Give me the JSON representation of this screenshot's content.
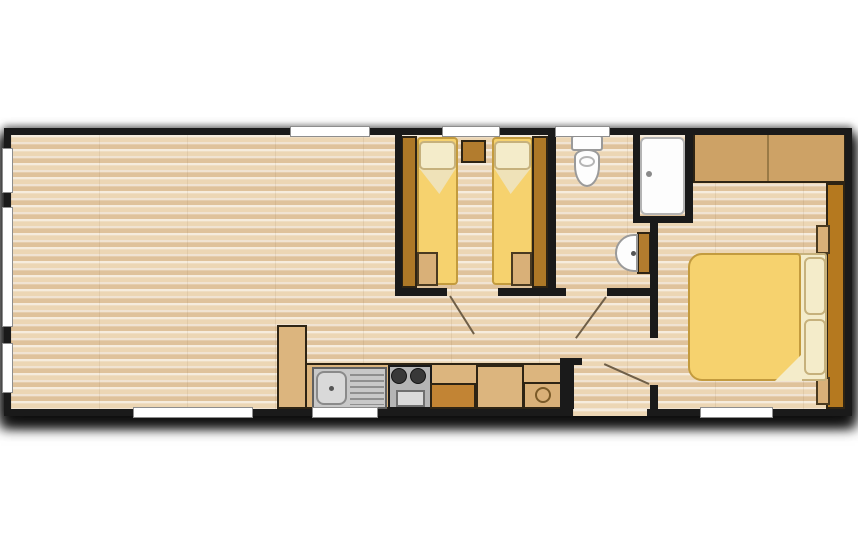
{
  "scene": {
    "title": "mobile-home-floor-plan",
    "description": "Top-down 2-bedroom static caravan floor plan: open lounge left, kitchen run along bottom, twin bedroom and shower room centre, double bedroom right",
    "colors": {
      "wall": "#1a1a1a",
      "floor_base": "#e8d0ad",
      "floor_stripe_light": "#ecd6b4",
      "floor_stripe_dark": "#dfc29b",
      "window_fill": "#ffffff",
      "window_border": "#8e8e8e",
      "wood_dark": "#ad7827",
      "wood_mid": "#cda266",
      "wood_light": "#d9b078",
      "counter_tan": "#dcb57e",
      "cabinet_orange": "#c28434",
      "bed_yellow": "#f6d26e",
      "bed_outline": "#c39b3e",
      "cream": "#f4ecca",
      "cream_outline": "#c6b17c",
      "fixture_white": "#fdfdfd",
      "fixture_border": "#9a9a9a",
      "appliance_gray": "#c8c8c8",
      "door_line": "#6f5f48"
    },
    "plan": {
      "x": 4,
      "y": 128,
      "w": 848,
      "h": 288
    }
  },
  "elements": [
    {
      "name": "floor-base",
      "kind": "rect",
      "cls": "floor",
      "x": 7,
      "y": 7,
      "w": 834,
      "h": 274
    },
    {
      "name": "twin-bedroom-wardrobe-left",
      "kind": "rect",
      "x": 397,
      "y": 8,
      "w": 16,
      "h": 152,
      "fill": "#ad7827",
      "stroke": "#2e2414",
      "sw": 2
    },
    {
      "name": "twin-bed-1-mattress",
      "kind": "rect",
      "x": 413,
      "y": 9,
      "w": 41,
      "h": 148,
      "fill": "#f6d26e",
      "stroke": "#c39b3e",
      "sw": 2,
      "r": "4px"
    },
    {
      "name": "twin-bed-1-sheet-fold",
      "kind": "tri",
      "x": 415,
      "y": 40,
      "w": 37,
      "h": 26,
      "fill": "#efe2b8",
      "clip": "polygon(0 0,100% 0,55% 100%)"
    },
    {
      "name": "twin-bed-1-pillow",
      "kind": "rect",
      "x": 415,
      "y": 13,
      "w": 37,
      "h": 29,
      "fill": "#f4ecca",
      "stroke": "#c6b17c",
      "sw": 2,
      "r": "5px"
    },
    {
      "name": "twin-bed-1-foot-chest",
      "kind": "rect",
      "x": 413,
      "y": 124,
      "w": 21,
      "h": 34,
      "fill": "#d9b078",
      "stroke": "#4a3a20",
      "sw": 2
    },
    {
      "name": "twin-bedside-cabinet",
      "kind": "rect",
      "x": 457,
      "y": 12,
      "w": 25,
      "h": 23,
      "fill": "#b27c2e",
      "stroke": "#2e2414",
      "sw": 2
    },
    {
      "name": "twin-bed-2-mattress",
      "kind": "rect",
      "x": 488,
      "y": 9,
      "w": 41,
      "h": 148,
      "fill": "#f6d26e",
      "stroke": "#c39b3e",
      "sw": 2,
      "r": "4px"
    },
    {
      "name": "twin-bed-2-sheet-fold",
      "kind": "tri",
      "x": 490,
      "y": 40,
      "w": 37,
      "h": 26,
      "fill": "#efe2b8",
      "clip": "polygon(0 0,100% 0,45% 100%)"
    },
    {
      "name": "twin-bed-2-pillow",
      "kind": "rect",
      "x": 490,
      "y": 13,
      "w": 37,
      "h": 29,
      "fill": "#f4ecca",
      "stroke": "#c6b17c",
      "sw": 2,
      "r": "5px"
    },
    {
      "name": "twin-bed-2-foot-chest",
      "kind": "rect",
      "x": 507,
      "y": 124,
      "w": 21,
      "h": 34,
      "fill": "#d9b078",
      "stroke": "#4a3a20",
      "sw": 2
    },
    {
      "name": "twin-bedroom-wardrobe-right",
      "kind": "rect",
      "x": 528,
      "y": 8,
      "w": 16,
      "h": 152,
      "fill": "#ad7827",
      "stroke": "#2e2414",
      "sw": 2
    },
    {
      "name": "toilet-cistern",
      "kind": "rect",
      "x": 567,
      "y": 7,
      "w": 32,
      "h": 16,
      "fill": "#fdfdfd",
      "stroke": "#9a9a9a",
      "sw": 2,
      "r": "3px"
    },
    {
      "name": "toilet-bowl",
      "kind": "rect",
      "x": 570,
      "y": 21,
      "w": 26,
      "h": 38,
      "fill": "#fdfdfd",
      "stroke": "#9a9a9a",
      "sw": 2,
      "r": "12px 12px 13px 13px / 8px 8px 21px 21px"
    },
    {
      "name": "toilet-seat-ring",
      "kind": "rect",
      "x": 575,
      "y": 28,
      "w": 16,
      "h": 11,
      "fill": "none",
      "stroke": "#b5b5b5",
      "sw": 2,
      "r": "50%"
    },
    {
      "name": "shower-tray",
      "kind": "rect",
      "x": 636,
      "y": 9,
      "w": 45,
      "h": 78,
      "fill": "#fdfdfd",
      "stroke": "#b4b4b4",
      "sw": 2,
      "r": "6px"
    },
    {
      "name": "shower-door-handle",
      "kind": "circle",
      "cx": 645,
      "cy": 46,
      "rr": 3,
      "fill": "#8a8a8a"
    },
    {
      "name": "basin-vanity",
      "kind": "rect",
      "x": 633,
      "y": 104,
      "w": 14,
      "h": 42,
      "fill": "#b27c2e",
      "stroke": "#2e2414",
      "sw": 2
    },
    {
      "name": "basin-bowl",
      "kind": "rect",
      "x": 611,
      "y": 106,
      "w": 23,
      "h": 38,
      "fill": "#fdfdfd",
      "stroke": "#9a9a9a",
      "sw": 2,
      "r": "19px 0 0 19px / 19px 0 0 19px"
    },
    {
      "name": "basin-tap",
      "kind": "circle",
      "cx": 629,
      "cy": 125,
      "rr": 2.5,
      "fill": "#555555"
    },
    {
      "name": "double-bedroom-wardrobe",
      "kind": "rect",
      "x": 689,
      "y": 5,
      "w": 153,
      "h": 50,
      "fill": "#cda266",
      "stroke": "#2e2414",
      "sw": 2
    },
    {
      "name": "double-bedroom-wardrobe-divider",
      "kind": "rect",
      "x": 763,
      "y": 7,
      "w": 2,
      "h": 46,
      "fill": "#9a7a46"
    },
    {
      "name": "double-bedroom-dresser-run",
      "kind": "rect",
      "x": 822,
      "y": 55,
      "w": 19,
      "h": 226,
      "fill": "#b5791f",
      "stroke": "#2e2414",
      "sw": 2
    },
    {
      "name": "bedside-shelf-top",
      "kind": "rect",
      "x": 812,
      "y": 97,
      "w": 14,
      "h": 29,
      "fill": "#d9b078",
      "stroke": "#4a3a20",
      "sw": 2
    },
    {
      "name": "bedside-shelf-bottom",
      "kind": "rect",
      "x": 812,
      "y": 249,
      "w": 14,
      "h": 28,
      "fill": "#d9b078",
      "stroke": "#4a3a20",
      "sw": 2
    },
    {
      "name": "double-bed-sheet",
      "kind": "rect",
      "x": 789,
      "y": 125,
      "w": 34,
      "h": 128,
      "fill": "#f4ecca",
      "stroke": "#c6b17c",
      "sw": 2,
      "r": "3px"
    },
    {
      "name": "double-bed-duvet",
      "kind": "rect",
      "x": 684,
      "y": 125,
      "w": 113,
      "h": 128,
      "fill": "#f6d26e",
      "stroke": "#c39b3e",
      "sw": 2,
      "r": "14px 4px 4px 14px"
    },
    {
      "name": "double-bed-duvet-fold",
      "kind": "tri",
      "x": 771,
      "y": 226,
      "w": 27,
      "h": 27,
      "fill": "#f4ecca",
      "clip": "polygon(100% 0,100% 100%,0 100%)"
    },
    {
      "name": "double-bed-pillow-1",
      "kind": "rect",
      "x": 800,
      "y": 129,
      "w": 22,
      "h": 58,
      "fill": "#f4ecca",
      "stroke": "#c6b17c",
      "sw": 2,
      "r": "6px"
    },
    {
      "name": "double-bed-pillow-2",
      "kind": "rect",
      "x": 800,
      "y": 191,
      "w": 22,
      "h": 56,
      "fill": "#f4ecca",
      "stroke": "#c6b17c",
      "sw": 2,
      "r": "6px"
    },
    {
      "name": "kitchen-tall-unit",
      "kind": "rect",
      "x": 273,
      "y": 197,
      "w": 30,
      "h": 84,
      "fill": "#dcb57e",
      "stroke": "#2e2414",
      "sw": 2
    },
    {
      "name": "kitchen-counter",
      "kind": "rect",
      "x": 301,
      "y": 235,
      "w": 257,
      "h": 46,
      "fill": "#dcb57e",
      "stroke": "#2e2414",
      "sw": 2
    },
    {
      "name": "sink-unit",
      "kind": "rect",
      "x": 308,
      "y": 239,
      "w": 75,
      "h": 42,
      "fill": "#c8c8c8",
      "stroke": "#606060",
      "sw": 2
    },
    {
      "name": "sink-bowl",
      "kind": "rect",
      "x": 312,
      "y": 243,
      "w": 31,
      "h": 34,
      "fill": "#d9d9d9",
      "stroke": "#8a8a8a",
      "sw": 2,
      "r": "8px"
    },
    {
      "name": "sink-drain",
      "kind": "circle",
      "cx": 327,
      "cy": 260,
      "rr": 2.5,
      "fill": "#555555"
    },
    {
      "name": "sink-drainer-board",
      "kind": "rect",
      "cls": "drainer",
      "x": 346,
      "y": 246,
      "w": 34,
      "h": 31
    },
    {
      "name": "cooker",
      "kind": "rect",
      "x": 384,
      "y": 237,
      "w": 44,
      "h": 44,
      "fill": "#b5b5b5",
      "stroke": "#1a1a1a",
      "sw": 2
    },
    {
      "name": "cooker-burner-1",
      "kind": "circle",
      "cx": 395,
      "cy": 248,
      "rr": 8,
      "fill": "#383838",
      "stroke": "#141414",
      "sw": 1
    },
    {
      "name": "cooker-burner-2",
      "kind": "circle",
      "cx": 414,
      "cy": 248,
      "rr": 8,
      "fill": "#383838",
      "stroke": "#141414",
      "sw": 1
    },
    {
      "name": "oven-door",
      "kind": "rect",
      "x": 392,
      "y": 262,
      "w": 29,
      "h": 17,
      "fill": "#dadada",
      "stroke": "#6f6f6f",
      "sw": 2
    },
    {
      "name": "kitchen-cabinet-dark",
      "kind": "rect",
      "x": 426,
      "y": 255,
      "w": 46,
      "h": 26,
      "fill": "#c28434",
      "stroke": "#2e2414",
      "sw": 2
    },
    {
      "name": "kitchen-cabinet-mid",
      "kind": "rect",
      "x": 472,
      "y": 237,
      "w": 48,
      "h": 44,
      "fill": "#dcb57e",
      "stroke": "#2e2414",
      "sw": 2
    },
    {
      "name": "water-heater-unit",
      "kind": "rect",
      "x": 519,
      "y": 254,
      "w": 40,
      "h": 27,
      "fill": "#d9b078",
      "stroke": "#2e2414",
      "sw": 2
    },
    {
      "name": "water-heater-ring",
      "kind": "circle",
      "cx": 539,
      "cy": 267,
      "rr": 8,
      "fill": "none",
      "stroke": "#7a5a28",
      "sw": 2
    },
    {
      "name": "wall-twin-left",
      "kind": "rect",
      "cls": "wall",
      "x": 391,
      "y": 7,
      "w": 7,
      "h": 161
    },
    {
      "name": "wall-twin-right",
      "kind": "rect",
      "cls": "wall",
      "x": 544,
      "y": 7,
      "w": 8,
      "h": 161
    },
    {
      "name": "wall-twin-bottom-a",
      "kind": "rect",
      "cls": "wall",
      "x": 391,
      "y": 160,
      "w": 52,
      "h": 8
    },
    {
      "name": "wall-twin-bottom-b",
      "kind": "rect",
      "cls": "wall",
      "x": 494,
      "y": 160,
      "w": 58,
      "h": 8
    },
    {
      "name": "wall-wc-bottom-left",
      "kind": "rect",
      "cls": "wall",
      "x": 544,
      "y": 160,
      "w": 18,
      "h": 8
    },
    {
      "name": "wall-wc-bottom-right",
      "kind": "rect",
      "cls": "wall",
      "x": 603,
      "y": 160,
      "w": 51,
      "h": 8
    },
    {
      "name": "wall-shower-left",
      "kind": "rect",
      "cls": "wall",
      "x": 629,
      "y": 7,
      "w": 7,
      "h": 88
    },
    {
      "name": "wall-shower-right",
      "kind": "rect",
      "cls": "wall",
      "x": 681,
      "y": 7,
      "w": 8,
      "h": 88
    },
    {
      "name": "wall-shower-bottom",
      "kind": "rect",
      "cls": "wall",
      "x": 629,
      "y": 88,
      "w": 60,
      "h": 7
    },
    {
      "name": "wall-wc-bedroom",
      "kind": "rect",
      "cls": "wall",
      "x": 646,
      "y": 95,
      "w": 8,
      "h": 67
    },
    {
      "name": "wall-hall-bedroom-upper",
      "kind": "rect",
      "cls": "wall",
      "x": 646,
      "y": 162,
      "w": 8,
      "h": 48
    },
    {
      "name": "wall-hall-bedroom-stub",
      "kind": "rect",
      "cls": "wall",
      "x": 646,
      "y": 257,
      "w": 8,
      "h": 24
    },
    {
      "name": "wall-kitchen-hall",
      "kind": "rect",
      "cls": "wall",
      "x": 556,
      "y": 230,
      "w": 14,
      "h": 51
    },
    {
      "name": "wall-kitchen-hall-stub",
      "kind": "rect",
      "cls": "wall",
      "x": 556,
      "y": 230,
      "w": 22,
      "h": 7
    },
    {
      "name": "wall-perimeter-top",
      "kind": "rect",
      "cls": "wall",
      "x": 0,
      "y": 0,
      "w": 848,
      "h": 7
    },
    {
      "name": "wall-perimeter-bottom",
      "kind": "rect",
      "cls": "wall",
      "x": 0,
      "y": 281,
      "w": 848,
      "h": 7
    },
    {
      "name": "wall-perimeter-left",
      "kind": "rect",
      "cls": "wall",
      "x": 0,
      "y": 0,
      "w": 7,
      "h": 288
    },
    {
      "name": "wall-perimeter-right",
      "kind": "rect",
      "cls": "wall",
      "x": 841,
      "y": 0,
      "w": 7,
      "h": 288
    },
    {
      "name": "entrance-door-opening",
      "kind": "rect",
      "cls": "floor",
      "x": 569,
      "y": 281,
      "w": 74,
      "h": 7
    },
    {
      "name": "window-top-lounge",
      "kind": "rect",
      "cls": "window",
      "x": 286,
      "y": -2,
      "w": 80,
      "h": 11
    },
    {
      "name": "window-top-twin-bedroom",
      "kind": "rect",
      "cls": "window",
      "x": 438,
      "y": -2,
      "w": 58,
      "h": 11
    },
    {
      "name": "window-top-wc",
      "kind": "rect",
      "cls": "window",
      "x": 551,
      "y": -2,
      "w": 55,
      "h": 11
    },
    {
      "name": "window-bottom-lounge",
      "kind": "rect",
      "cls": "window",
      "x": 129,
      "y": 279,
      "w": 120,
      "h": 11
    },
    {
      "name": "window-bottom-kitchen",
      "kind": "rect",
      "cls": "window",
      "x": 308,
      "y": 279,
      "w": 66,
      "h": 11
    },
    {
      "name": "window-bottom-double-bedroom",
      "kind": "rect",
      "cls": "window",
      "x": 696,
      "y": 279,
      "w": 73,
      "h": 11
    },
    {
      "name": "window-left-end-1",
      "kind": "rect",
      "cls": "window",
      "x": -2,
      "y": 20,
      "w": 11,
      "h": 45
    },
    {
      "name": "window-left-end-2",
      "kind": "rect",
      "cls": "window",
      "x": -2,
      "y": 79,
      "w": 11,
      "h": 120
    },
    {
      "name": "window-left-end-3",
      "kind": "rect",
      "cls": "window",
      "x": -2,
      "y": 215,
      "w": 11,
      "h": 50
    },
    {
      "name": "twin-bedroom-door-leaf",
      "kind": "line",
      "x1": 446,
      "y1": 168,
      "x2": 470,
      "y2": 206,
      "stroke": "#6f5f48",
      "lw": 2
    },
    {
      "name": "wc-door-leaf",
      "kind": "line",
      "x1": 602,
      "y1": 169,
      "x2": 572,
      "y2": 210,
      "stroke": "#6f5f48",
      "lw": 2
    },
    {
      "name": "double-bedroom-door-leaf",
      "kind": "line",
      "x1": 645,
      "y1": 256,
      "x2": 600,
      "y2": 236,
      "stroke": "#6f5f48",
      "lw": 2
    }
  ]
}
